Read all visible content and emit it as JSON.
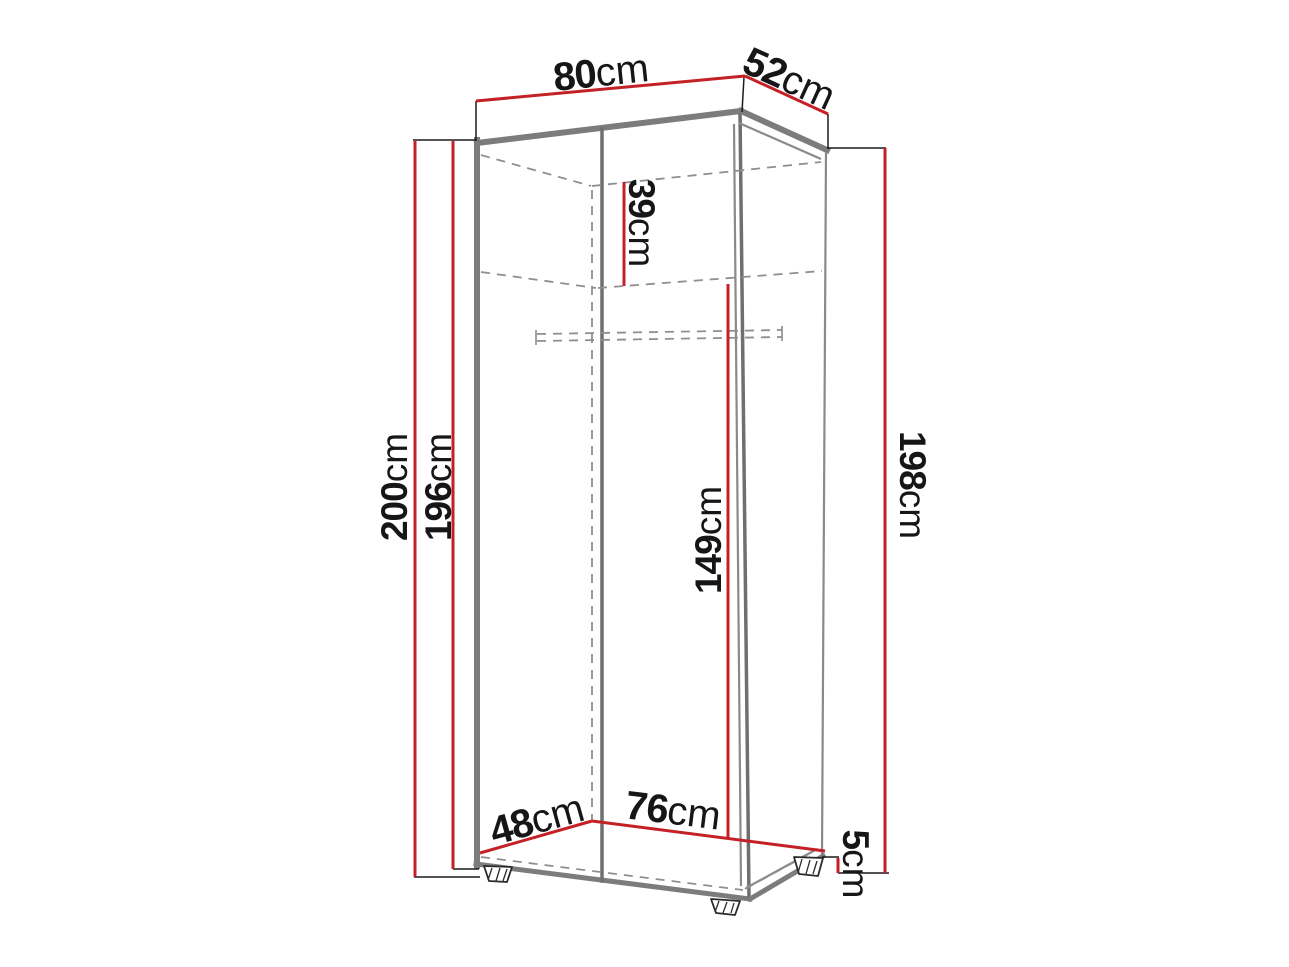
{
  "diagram": {
    "kind": "furniture-dimension-drawing",
    "unit": "cm",
    "colors": {
      "dimension_line": "#c42127",
      "outline": "#7c7c7c",
      "hidden_edge": "#8f8f8f",
      "extension_line": "#1c1c1c",
      "label_text": "#161616",
      "background": "#ffffff"
    },
    "dimensions": {
      "top_width": {
        "num": "80",
        "unit": "cm"
      },
      "top_depth": {
        "num": "52",
        "unit": "cm"
      },
      "height_left_outer": {
        "num": "200",
        "unit": "cm"
      },
      "height_left_inner": {
        "num": "196",
        "unit": "cm"
      },
      "height_right": {
        "num": "198",
        "unit": "cm"
      },
      "top_compartment": {
        "num": "39",
        "unit": "cm"
      },
      "inner_height": {
        "num": "149",
        "unit": "cm"
      },
      "bottom_depth": {
        "num": "48",
        "unit": "cm"
      },
      "bottom_width": {
        "num": "76",
        "unit": "cm"
      },
      "feet_height": {
        "num": "5",
        "unit": "cm"
      }
    }
  }
}
